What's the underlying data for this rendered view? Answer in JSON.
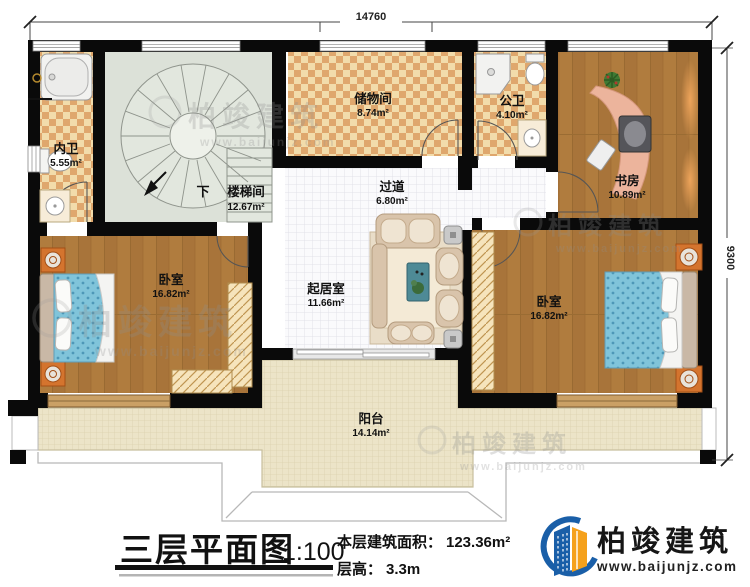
{
  "plan": {
    "rooms": [
      {
        "name": "内卫",
        "area": "5.55m²"
      },
      {
        "name": "楼梯间",
        "area": "12.67m²"
      },
      {
        "name": "储物间",
        "area": "8.74m²"
      },
      {
        "name": "公卫",
        "area": "4.10m²"
      },
      {
        "name": "书房",
        "area": "10.89m²"
      },
      {
        "name": "过道",
        "area": "6.80m²"
      },
      {
        "name": "卧室",
        "area": "16.82m²"
      },
      {
        "name": "起居室",
        "area": "11.66m²"
      },
      {
        "name": "卧室",
        "area": "16.82m²"
      },
      {
        "name": "阳台",
        "area": "14.14m²"
      }
    ],
    "stair_down_label": "下",
    "dim_top": "14760",
    "dim_right": "9300"
  },
  "titleblock": {
    "title": "三层平面图",
    "scale": "1:100",
    "area_label": "本层建筑面积：",
    "area_value": "123.36m²",
    "height_label": "层高：",
    "height_value": "3.3m"
  },
  "brand": {
    "name": "柏竣建筑",
    "website": "www.baijunjz.com"
  },
  "watermark": {
    "name": "柏竣建筑",
    "website": "www.baijunjz.com"
  },
  "colors": {
    "accent_blue": "#1a5fa8",
    "accent_orange": "#f5a11c",
    "wall": "#0a0a0a"
  }
}
